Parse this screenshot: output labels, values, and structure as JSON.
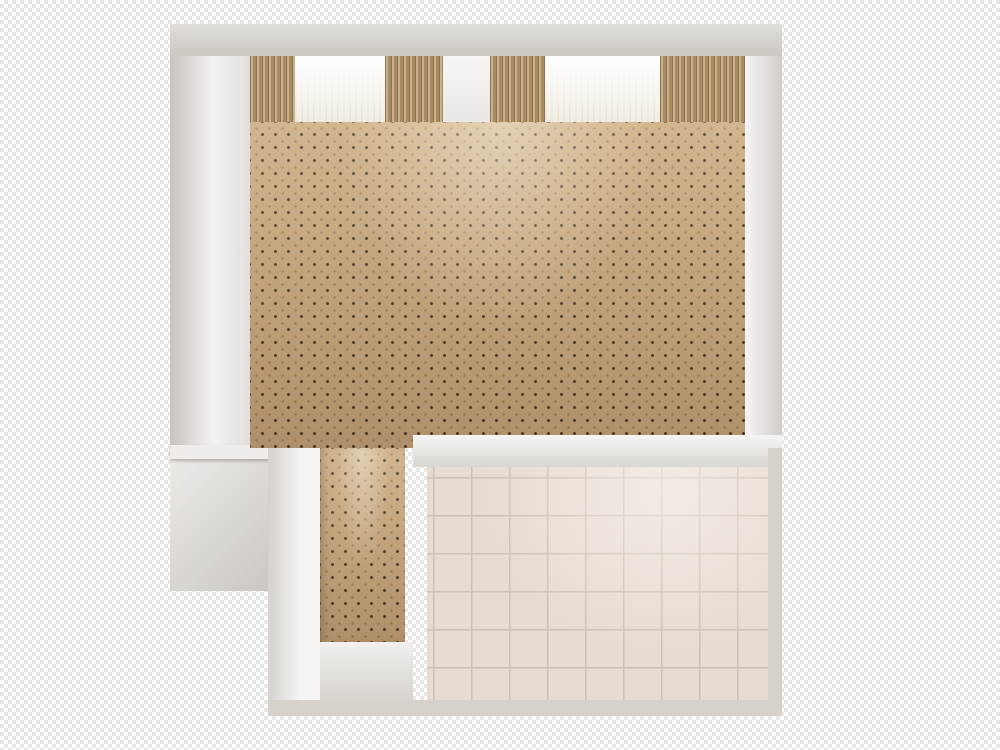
{
  "scene": {
    "type": "3d-floor-plan-render",
    "view": "top-down",
    "setting": "hotel studio suite floor plan",
    "background": "transparency-checkerboard",
    "text_content": "none"
  },
  "palette": {
    "checker": "#e7e7e7",
    "wall_outer": "#d6d1cb",
    "wall_face": "#efecea",
    "wall_shade": "#dcd8d3",
    "carpet": "#c9a87d",
    "curtain": "#b99b6f",
    "sheer": "#f4f1ea",
    "window_bay": "#f3f1ef",
    "tile": "#e6dcd1",
    "grout": "#ccc1b5",
    "tile_wall": "#e9d8cb",
    "counter": "#f0eeec",
    "tub": "#f4efe7",
    "tub_inner": "#efe7da",
    "marble": "#25302a",
    "mirror": "#21251f",
    "porcelain": "#f4f0e8",
    "bench": "#ece2d4",
    "sofa": "#96485b",
    "cushion": "#9d4b60",
    "chair_shell": "#8b8c91",
    "glass_table": "#dfe3e2",
    "desk_wood": "#4c3a2b",
    "wardrobe_wood": "#5d4731",
    "door_brown": "#4e3b28",
    "headboard": "#3f2114",
    "nightstand": "#3a1d12",
    "lamp_cream": "#f4ebc8",
    "linen": "#f3f3f5",
    "tv_gray": "#3b3e43",
    "rack_gray": "#35373c",
    "steel": "#b9bec2",
    "chrome": "#c7cbd0",
    "menu_olive": "#b2ab84",
    "book_blue": "#5d7fa3",
    "frame_gold": "#b09a55",
    "towel": "#f6f4ef",
    "entry_floor": "#e8e4e0"
  },
  "rooms": [
    {
      "name": "bedroom-living-area",
      "floor": "dotted-carpet",
      "items": [
        "double-bed",
        "duvet",
        "pillow",
        "pillow",
        "dark-wood-headboard",
        "nightstand-lamp",
        "nightstand-lamp",
        "writing-desk",
        "desk-lamp",
        "open-book",
        "notebook",
        "office-chair",
        "wall-mirror",
        "wall-art",
        "sofa",
        "sofa-pillow",
        "sofa-pillow",
        "armchair",
        "armchair",
        "glass-coffee-table",
        "floor-lamp",
        "tv",
        "luggage-rack",
        "counter-menus"
      ]
    },
    {
      "name": "window-wall",
      "items": [
        "pleated-curtain",
        "sheer-drape",
        "window-bay",
        "pleated-curtain",
        "sheer-drape",
        "pleated-curtain"
      ]
    },
    {
      "name": "kitchenette-nook",
      "items": [
        "stainless-sink",
        "four-burner-cooktop"
      ]
    },
    {
      "name": "bathroom",
      "floor": "ceramic-tile",
      "items": [
        "shower-stall",
        "shower-faucet",
        "glass-shelf",
        "slippers",
        "corner-bathtub",
        "tub-tap",
        "towel-bar",
        "vanity-counter",
        "vanity-sink",
        "vanity-faucet",
        "toiletries",
        "towel-stack",
        "vanity-mirror",
        "wall-sconce",
        "wall-sconce",
        "toilet",
        "toilet-paper-holder",
        "spare-roll",
        "bench",
        "bench"
      ]
    },
    {
      "name": "entry-hall",
      "floor": "carpet-and-stone",
      "items": [
        "wardrobe",
        "wall-art",
        "entry-door",
        "door-handle",
        "bathroom-door",
        "door-hinge"
      ]
    }
  ]
}
